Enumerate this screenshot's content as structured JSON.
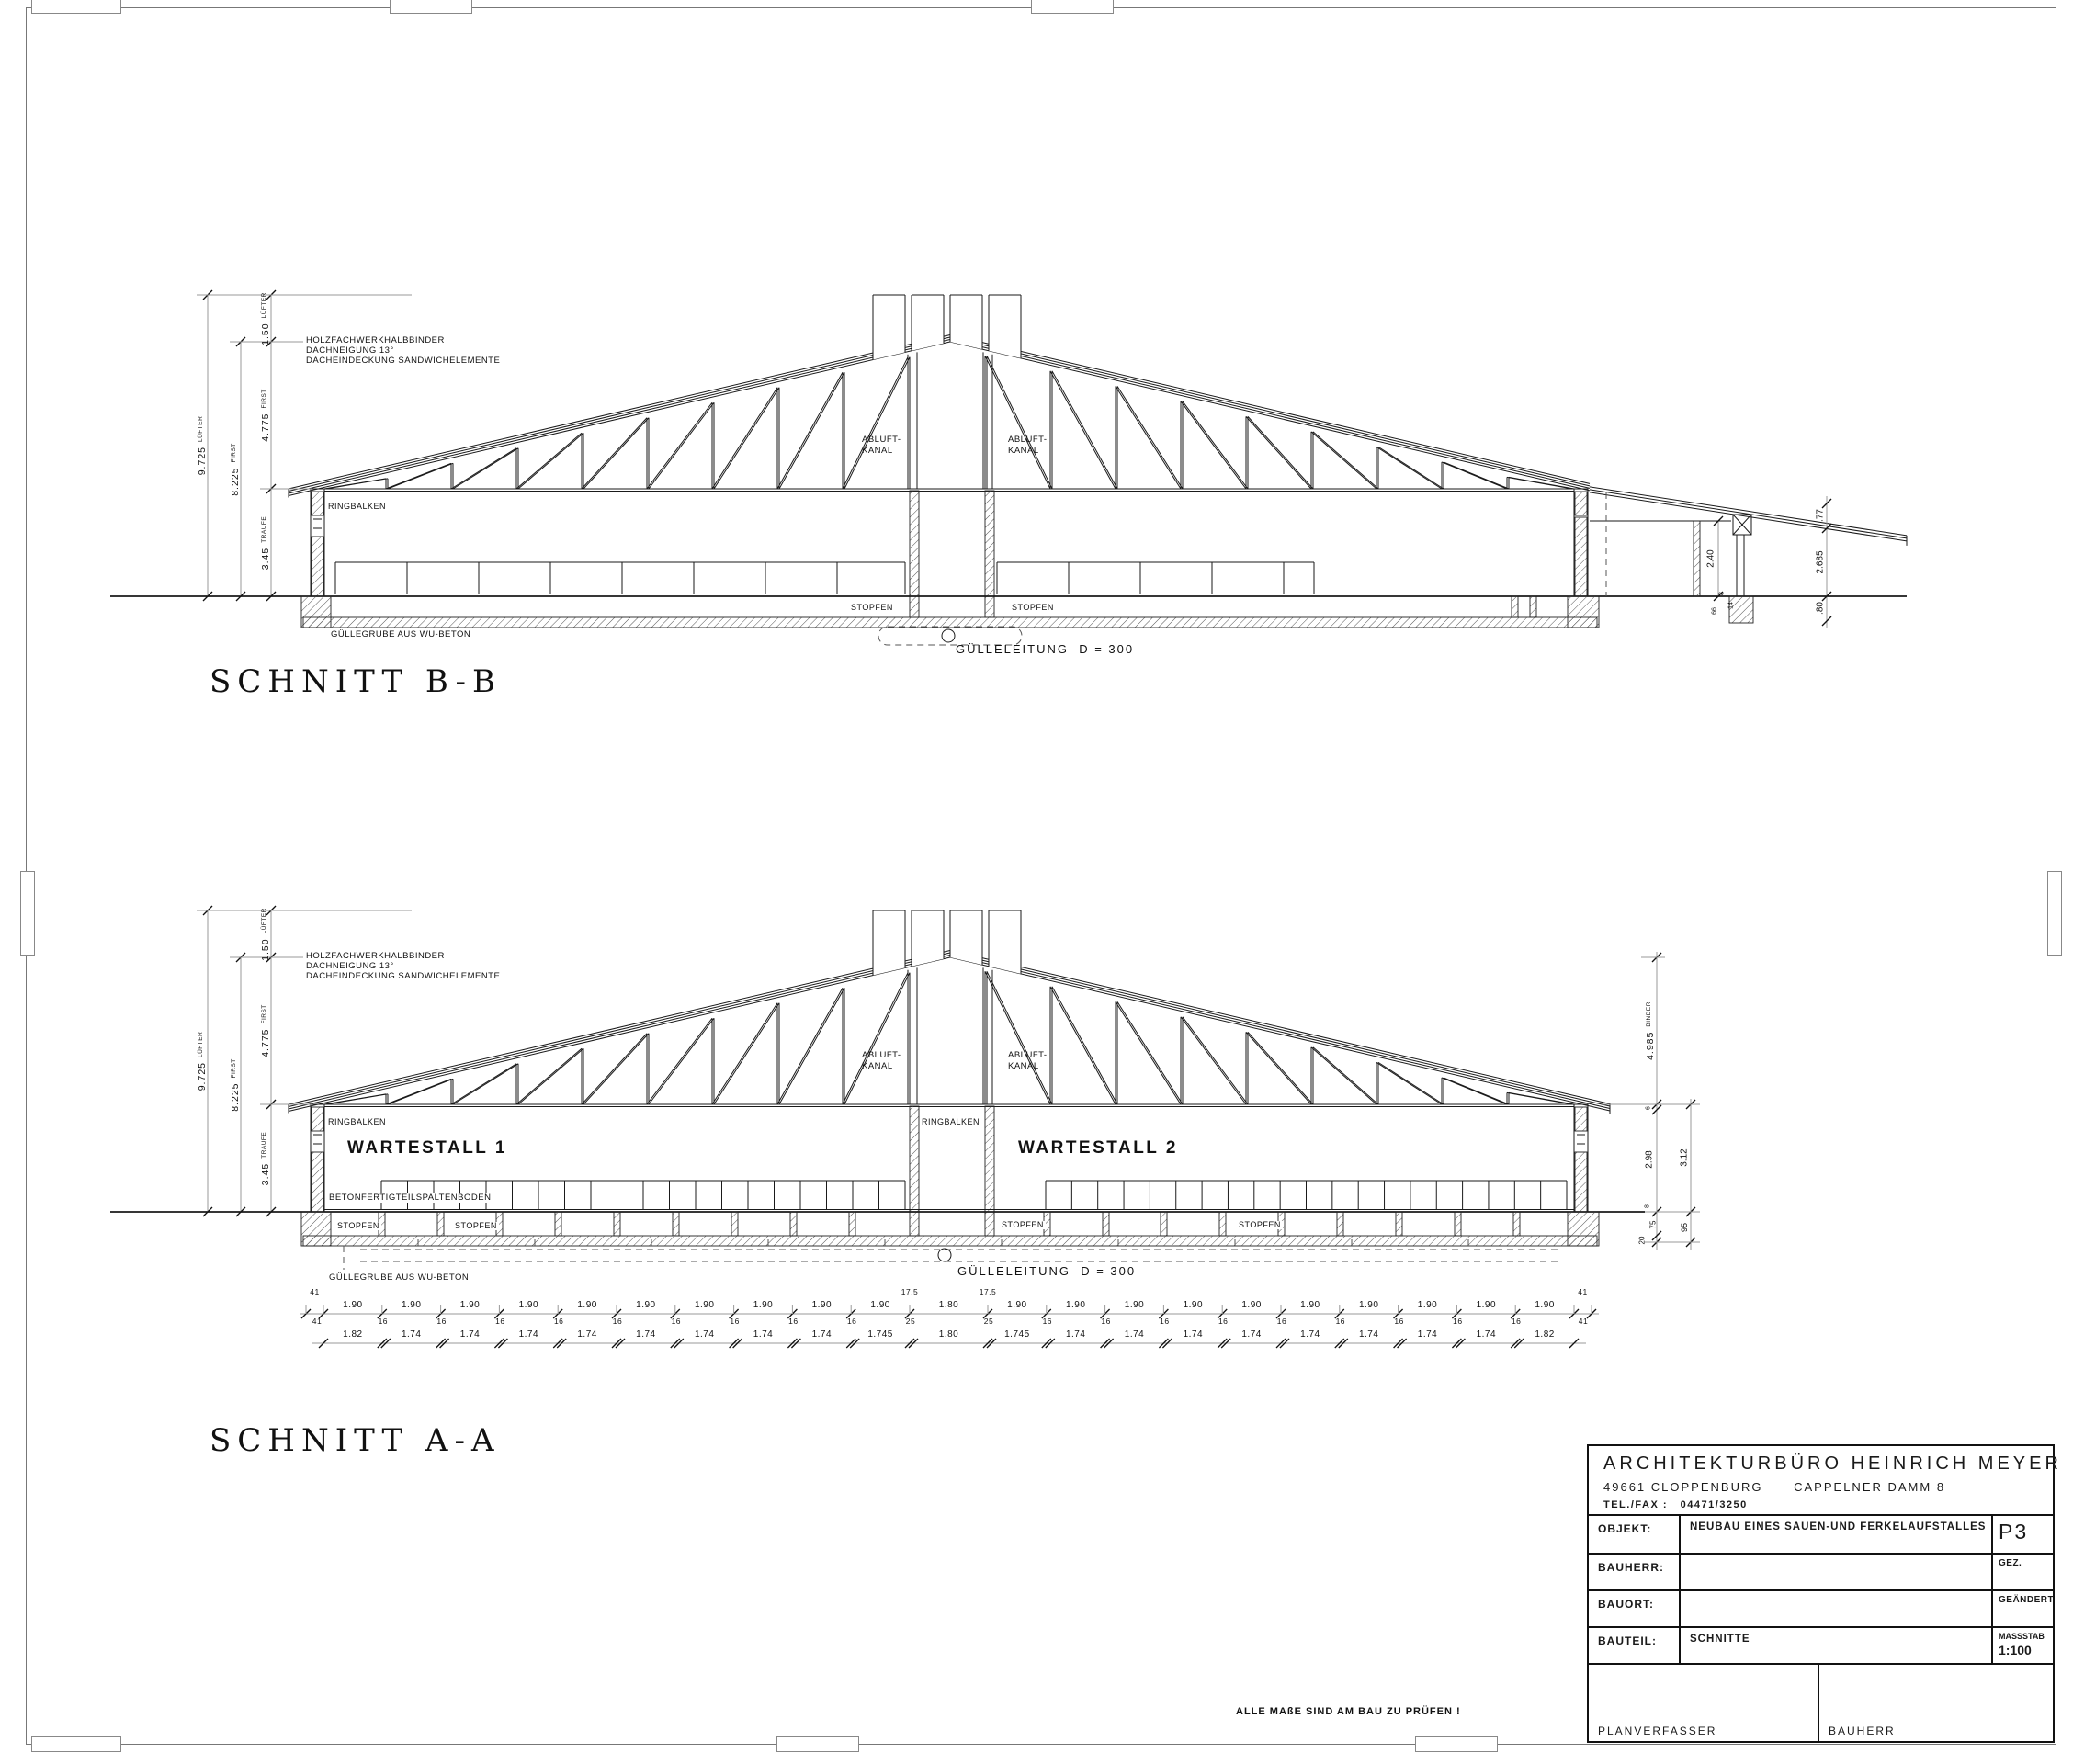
{
  "sheet": {
    "note": "ALLE MAßE SIND AM BAU ZU PRÜFEN !"
  },
  "colors": {
    "ink": "#1a1a1a",
    "dim_line": "#9a9a9a"
  },
  "sections": {
    "b": {
      "title": "SCHNITT B-B"
    },
    "a": {
      "title": "SCHNITT A-A"
    }
  },
  "annotation": [
    "HOLZFACHWERKHALBBINDER",
    "DACHNEIGUNG 13°",
    "DACHEINDECKUNG SANDWICHELEMENTE"
  ],
  "labels": {
    "ringbalken": "RINGBALKEN",
    "abluft1": "ABLUFT-",
    "abluft2": "KANAL",
    "stopfen": "STOPFEN",
    "guelleleitung": "GÜLLELEITUNG  D = 300",
    "guellegrube": "GÜLLEGRUBE AUS WU-BETON",
    "wartestall1": "WARTESTALL 1",
    "wartestall2": "WARTESTALL 2",
    "spaltenboden": "BETONFERTIGTEILSPALTENBODEN"
  },
  "dims_left": [
    {
      "v": "9.725",
      "s": "LÜFTER"
    },
    {
      "v": "8.225",
      "s": "FIRST"
    },
    {
      "v": "1.50",
      "s": "LÜFTER"
    },
    {
      "v": "4.775",
      "s": "FIRST"
    },
    {
      "v": "3.45",
      "s": "TRAUFE"
    }
  ],
  "dims_b": {
    "d77": ".77",
    "d2685": "2.685",
    "d80": ".80",
    "d240": "2.40",
    "d8": "8",
    "d14": "14",
    "d66": "66"
  },
  "dims_a": {
    "binder_v": "4.985",
    "binder_s": "BINDER",
    "d6": "6",
    "d298": "2.98",
    "d8": "8",
    "d75": "75",
    "d20": "20",
    "d312": "3.12",
    "d95": "95"
  },
  "chains": {
    "top": [
      "41",
      "1.90",
      "1.90",
      "1.90",
      "1.90",
      "1.90",
      "1.90",
      "1.90",
      "1.90",
      "1.90",
      "1.90",
      "1.80",
      "1.90",
      "1.90",
      "1.90",
      "1.90",
      "1.90",
      "1.90",
      "1.90",
      "1.90",
      "1.90",
      "1.90",
      "41"
    ],
    "mid": [
      "41",
      "16",
      "16",
      "16",
      "16",
      "16",
      "16",
      "16",
      "16",
      "16",
      "25",
      "25",
      "16",
      "16",
      "16",
      "16",
      "16",
      "16",
      "16",
      "16",
      "16",
      "41"
    ],
    "mid_top": [
      "17.5",
      "17.5"
    ],
    "bottom": [
      "1.82",
      "1.74",
      "1.74",
      "1.74",
      "1.74",
      "1.74",
      "1.74",
      "1.74",
      "1.74",
      "1.745",
      "1.80",
      "1.745",
      "1.74",
      "1.74",
      "1.74",
      "1.74",
      "1.74",
      "1.74",
      "1.74",
      "1.74",
      "1.82"
    ]
  },
  "titleblock": {
    "firm": "ARCHITEKTURBÜRO HEINRICH MEYER",
    "address": "49661 CLOPPENBURG      CAPPELNER DAMM 8",
    "tel": "TEL./FAX :   04471/3250",
    "objekt_label": "OBJEKT:",
    "objekt_value": "NEUBAU EINES SAUEN-UND FERKELAUFSTALLES",
    "pl n": "",
    "plan_no": "P3",
    "bauherr_label": "BAUHERR:",
    "gez_label": "GEZ.",
    "bauort_label": "BAUORT:",
    "geaendert_label": "GEÄNDERT",
    "bauteil_label": "BAUTEIL:",
    "bauteil_value": "SCHNITTE",
    "massstab_label": "MASSSTAB",
    "massstab_value": "1:100",
    "planverfasser_label": "PLANVERFASSER",
    "bauherr_bottom_label": "BAUHERR"
  }
}
